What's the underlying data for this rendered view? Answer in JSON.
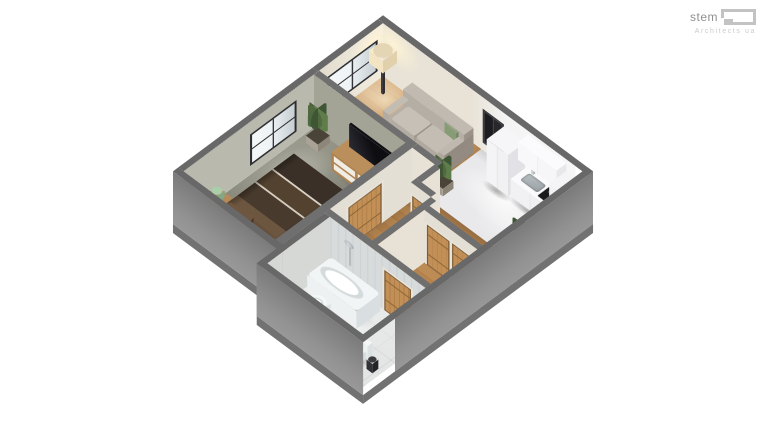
{
  "brand": {
    "name": "stem",
    "tagline": "Architects ua"
  },
  "scene": {
    "type": "isometric-3d-floor-plan-render",
    "background": "#ffffff",
    "palette": {
      "wall_top": "#6f6f6f",
      "wall_exterior": "#8e8e8e",
      "wall_interior_warm": "#ece6dc",
      "wall_interior_bedroom": "#b3b3a7",
      "wood_floor": "#c2925c",
      "carpet_floor": "#8a8a7e",
      "kitchen_floor": "#e9e9eb",
      "bathroom_floor": "#e7e8e8",
      "door_wood": "#b8864e",
      "sofa_fabric": "#b7b0a6",
      "bed_textile": "#3a2f26",
      "accent_green": "#5d7a4e"
    },
    "rooms": [
      {
        "name": "living-room",
        "floor": "wood",
        "furniture": [
          "sofa",
          "green-pillows",
          "floor-lamp",
          "window",
          "potted-plant"
        ]
      },
      {
        "name": "kitchen",
        "floor": "white",
        "furniture": [
          "fridge",
          "upper-cabinets",
          "counter",
          "sink",
          "faucet",
          "cooktop",
          "tall-corner-cabinet",
          "plants",
          "dark-window"
        ]
      },
      {
        "name": "bedroom",
        "floor": "carpet",
        "furniture": [
          "double-bed",
          "headboard",
          "brown-pillows",
          "nightstand",
          "green-table-lamp",
          "tv",
          "tv-dresser",
          "foot-bench",
          "tall-plant",
          "window"
        ]
      },
      {
        "name": "bathroom",
        "floor": "tile",
        "furniture": [
          "bathtub",
          "shower-head",
          "pedestal-sink",
          "toilet",
          "waste-bin",
          "wooden-door"
        ]
      },
      {
        "name": "hallway",
        "floor": "wood",
        "furniture": [
          "wooden-doors",
          "door-casings"
        ]
      }
    ]
  }
}
